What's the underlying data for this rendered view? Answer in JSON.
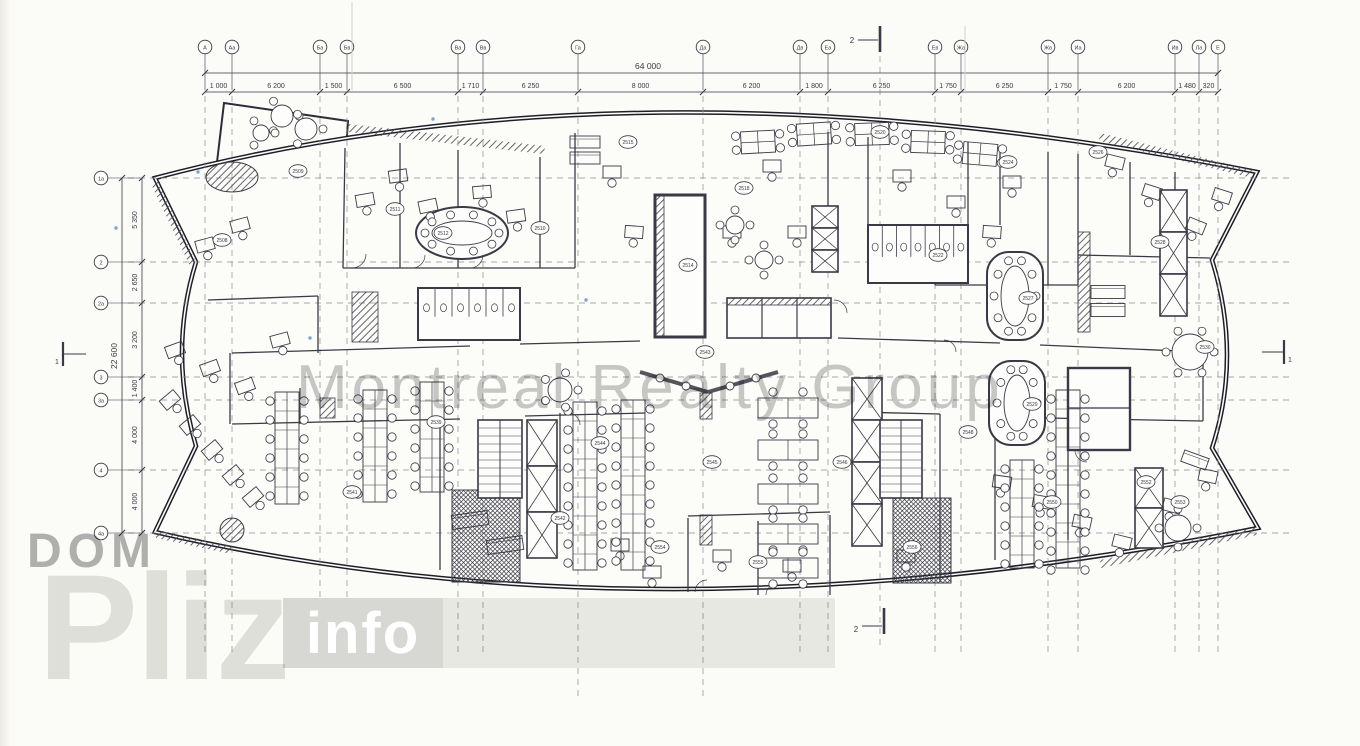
{
  "document": {
    "kind": "scanned architectural floor plan",
    "building_shape": "lens / ship-shaped office floor"
  },
  "watermark": {
    "center": "Montreal Realty Group",
    "logo_top": "DOM",
    "logo_big": "Pliz",
    "logo_badge": "info"
  },
  "dimensions": {
    "overall_width": "64 000",
    "overall_height": "22 600",
    "column_spacings": [
      "1 000",
      "6 200",
      "1 500",
      "6 500",
      "1 710",
      "6 250",
      "8 000",
      "6 200",
      "1 800",
      "6 250",
      "1 750",
      "6 250",
      "1 750",
      "6 200",
      "1 480",
      "320"
    ],
    "row_spacings": [
      "5 350",
      "2 650",
      "3 200",
      "1 400",
      "4 000",
      "4 000"
    ]
  },
  "grid": {
    "columns": [
      {
        "label": "А",
        "x": 205
      },
      {
        "label": "Аа",
        "x": 232
      },
      {
        "label": "Ба",
        "x": 320
      },
      {
        "label": "Бв",
        "x": 347
      },
      {
        "label": "Ва",
        "x": 458
      },
      {
        "label": "Вв",
        "x": 483
      },
      {
        "label": "Га",
        "x": 578
      },
      {
        "label": "Да",
        "x": 703
      },
      {
        "label": "Дв",
        "x": 800
      },
      {
        "label": "Еа",
        "x": 828
      },
      {
        "label": "Ев",
        "x": 935
      },
      {
        "label": "Жа",
        "x": 961
      },
      {
        "label": "Жв",
        "x": 1048
      },
      {
        "label": "Иа",
        "x": 1078
      },
      {
        "label": "Ив",
        "x": 1175
      },
      {
        "label": "Ла",
        "x": 1199
      },
      {
        "label": "Е",
        "x": 1218
      }
    ],
    "rows": [
      {
        "label": "1а",
        "y": 178
      },
      {
        "label": "2",
        "y": 262
      },
      {
        "label": "2а",
        "y": 303
      },
      {
        "label": "3",
        "y": 377
      },
      {
        "label": "3а",
        "y": 400
      },
      {
        "label": "4",
        "y": 470
      },
      {
        "label": "4а",
        "y": 533
      }
    ]
  },
  "section_markers": [
    {
      "label": "2",
      "position": "top"
    },
    {
      "label": "2",
      "position": "bottom"
    },
    {
      "label": "1",
      "position": "left"
    },
    {
      "label": "1",
      "position": "right"
    }
  ],
  "room_tags": [
    {
      "t": "2508",
      "x": 222,
      "y": 240
    },
    {
      "t": "2509",
      "x": 298,
      "y": 171
    },
    {
      "t": "2511",
      "x": 395,
      "y": 209
    },
    {
      "t": "2512",
      "x": 443,
      "y": 233
    },
    {
      "t": "2510",
      "x": 540,
      "y": 228
    },
    {
      "t": "2515",
      "x": 628,
      "y": 142
    },
    {
      "t": "2514",
      "x": 688,
      "y": 265
    },
    {
      "t": "2518",
      "x": 744,
      "y": 188
    },
    {
      "t": "2520",
      "x": 880,
      "y": 132
    },
    {
      "t": "2522",
      "x": 938,
      "y": 255
    },
    {
      "t": "2524",
      "x": 1008,
      "y": 162
    },
    {
      "t": "2526",
      "x": 1098,
      "y": 152
    },
    {
      "t": "2528",
      "x": 1160,
      "y": 242
    },
    {
      "t": "2530",
      "x": 1205,
      "y": 347
    },
    {
      "t": "2527",
      "x": 1028,
      "y": 298
    },
    {
      "t": "2529",
      "x": 1032,
      "y": 404
    },
    {
      "t": "2541",
      "x": 352,
      "y": 492
    },
    {
      "t": "2539",
      "x": 436,
      "y": 422
    },
    {
      "t": "2544",
      "x": 600,
      "y": 443
    },
    {
      "t": "2545",
      "x": 712,
      "y": 462
    },
    {
      "t": "2546",
      "x": 842,
      "y": 462
    },
    {
      "t": "2548",
      "x": 968,
      "y": 432
    },
    {
      "t": "2550",
      "x": 1052,
      "y": 502
    },
    {
      "t": "2552",
      "x": 1146,
      "y": 482
    },
    {
      "t": "2543",
      "x": 705,
      "y": 352
    },
    {
      "t": "2542",
      "x": 560,
      "y": 518
    },
    {
      "t": "2554",
      "x": 660,
      "y": 547
    },
    {
      "t": "2555",
      "x": 758,
      "y": 562
    },
    {
      "t": "2556",
      "x": 912,
      "y": 547
    },
    {
      "t": "2553",
      "x": 1180,
      "y": 502
    }
  ],
  "colors": {
    "paper": "#fbfbf8",
    "ink": "#3a3a46",
    "wall": "#1e1e28",
    "grid_line": "#8a8a92",
    "watermark_gray": "#7d7d7d",
    "logo_gray": "#aaaaaa",
    "logo_light": "#e3e3e0",
    "badge_bg": "#d7d7d4",
    "badge_text": "#ffffff",
    "blue_speck": "#4a79cc"
  }
}
